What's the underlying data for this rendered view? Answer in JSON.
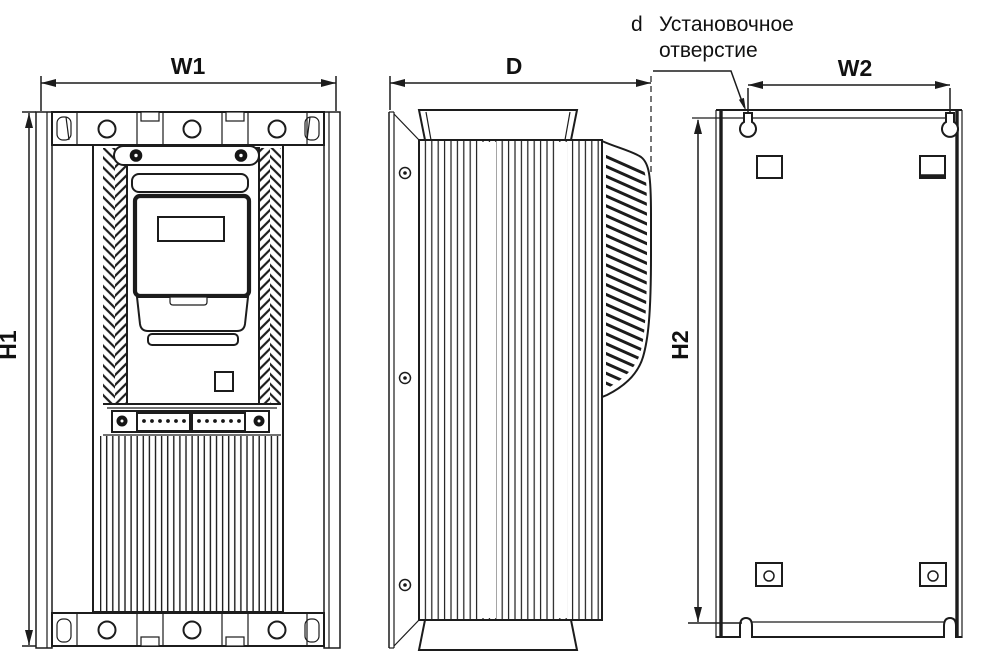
{
  "figure": {
    "kind": "technical-drawing",
    "views": [
      "front-view",
      "side-view",
      "rear-mounting-plate-view"
    ],
    "background_color": "#ffffff",
    "line_color": "#1c1c1c"
  },
  "dimensions": {
    "w1": "W1",
    "d": "D",
    "w2": "W2",
    "h1": "H1",
    "h2": "H2"
  },
  "annotation": {
    "symbol": "d",
    "line1": "Установочное",
    "line2": "отверстие"
  }
}
